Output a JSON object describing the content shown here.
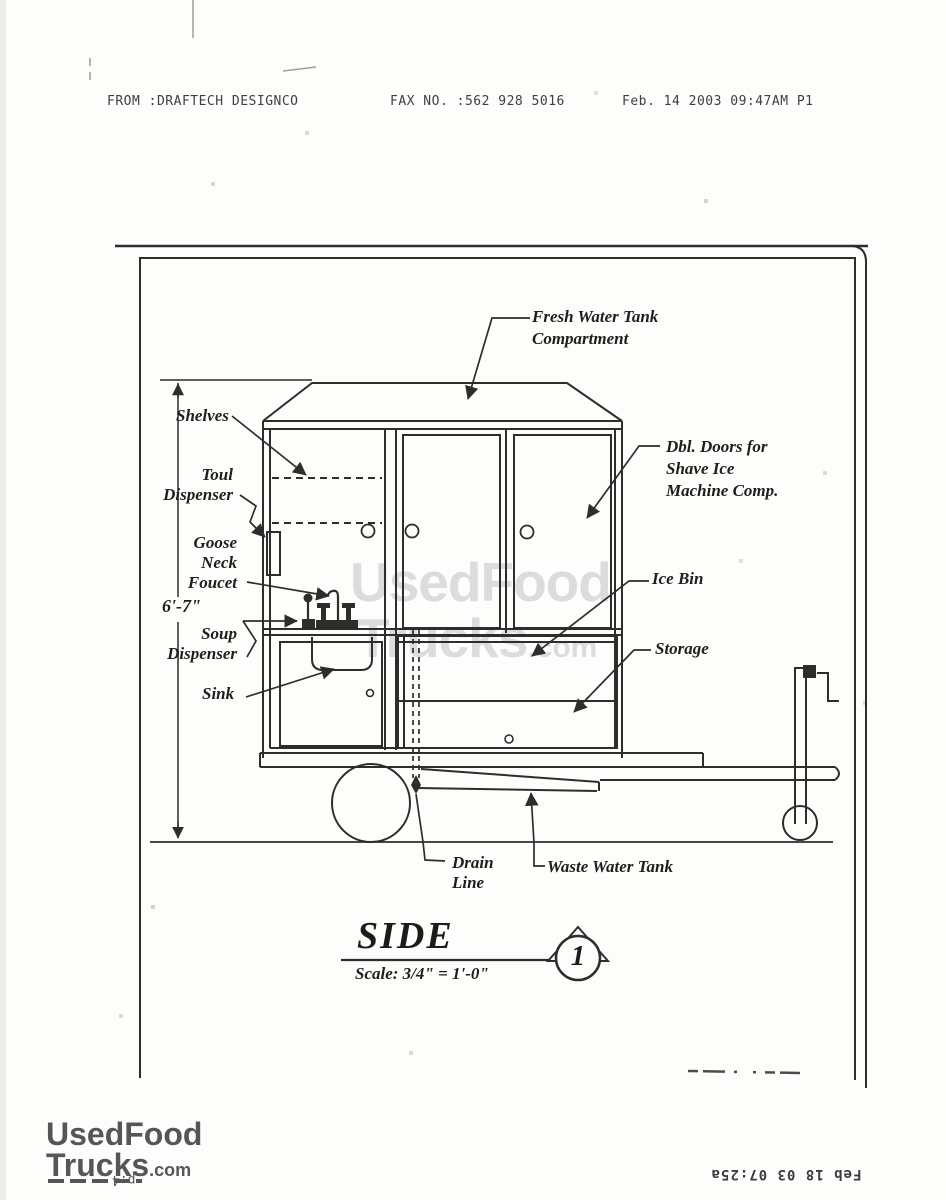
{
  "fax_header": {
    "from_line": "FROM :DRAFTECH DESIGNCO",
    "fax_line": "FAX NO. :562 928 5016",
    "date_line": "Feb. 14 2003 09:47AM  P1"
  },
  "diagram": {
    "labels": {
      "fresh_water_tank": "Fresh Water Tank\nCompartment",
      "shelves": "Shelves",
      "toul_dispenser": "Toul\nDispenser",
      "goose_neck_foucet": "Goose\nNeck\nFoucet",
      "soup_dispenser": "Soup\nDispenser",
      "sink": "Sink",
      "dbl_doors": "Dbl. Doors for\nShave Ice\nMachine Comp.",
      "ice_bin": "Ice Bin",
      "storage": "Storage",
      "drain_line": "Drain\nLine",
      "waste_water_tank": "Waste Water Tank"
    },
    "dimension": "6'-7\"",
    "title": "SIDE",
    "scale_note": "Scale:  3/4\" = 1'-0\"",
    "detail_number": "1"
  },
  "watermark": {
    "line1": "UsedFood",
    "line2": "Trucks",
    "suffix": ".com"
  },
  "footer_logo": {
    "line1": "UsedFood",
    "line2": "Trucks",
    "suffix": ".com",
    "page_note": "p.4"
  },
  "fax_footer": {
    "timestamp": "Feb 18 03 07:25a"
  },
  "colors": {
    "ink": "#2e2d2b",
    "watermark": "#dcdcdc",
    "logo": "#565656"
  }
}
